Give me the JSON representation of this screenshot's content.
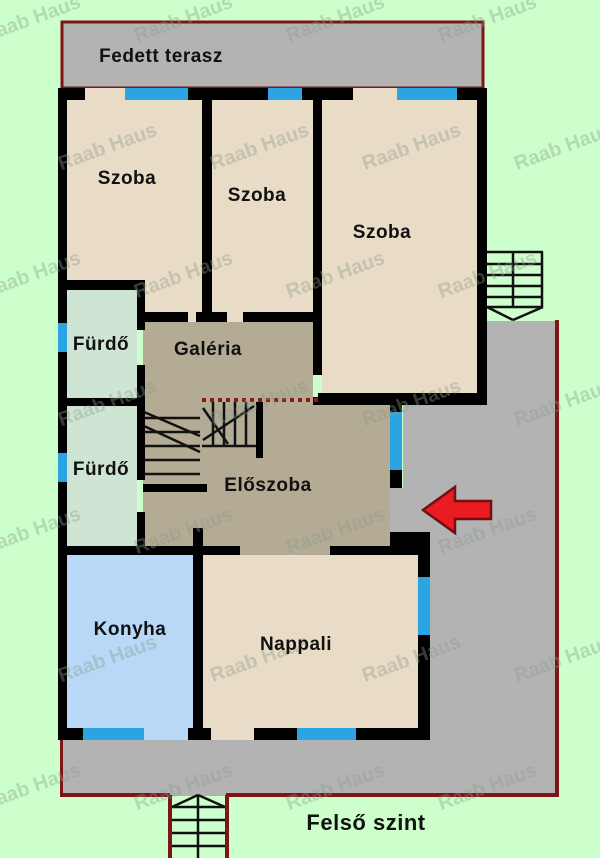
{
  "document": {
    "type": "floor-plan",
    "floor_title": "Felső szint",
    "watermark_text": "Raab Haus"
  },
  "labels": {
    "covered_terrace": "Fedett terasz",
    "room_top_left": "Szoba",
    "room_top_middle": "Szoba",
    "room_top_right": "Szoba",
    "bathroom_upper": "Fürdő",
    "bathroom_lower": "Fürdő",
    "gallery": "Galéria",
    "hallway": "Előszoba",
    "kitchen": "Konyha",
    "living_room": "Nappali",
    "floor_title": "Felső szint",
    "watermark": "Raab Haus"
  },
  "colors": {
    "background_green": "#ccffcc",
    "terrace_gray": "#b3b3b3",
    "wall_black": "#000000",
    "room_beige": "#e8dcc6",
    "hall_olive": "#b3ab93",
    "bathroom_green": "#cfe5d3",
    "kitchen_blue": "#b7d8f6",
    "window_blue": "#2aa4e2",
    "border_dark_red": "#7d1416",
    "arrow_red": "#ea1c22",
    "gallery_open_edge_dotted_red": "#8b1a10"
  }
}
